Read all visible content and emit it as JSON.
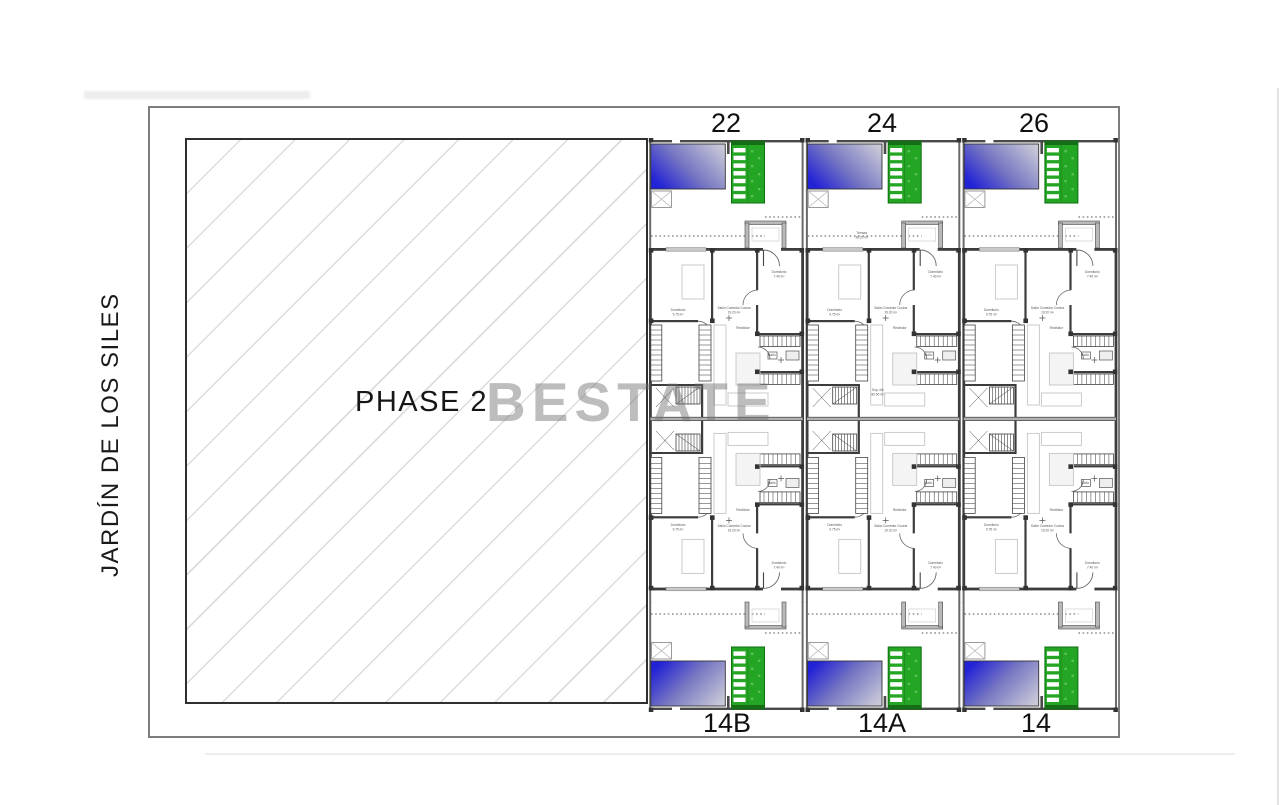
{
  "site_plan": {
    "street_label": "JARDÍN DE LOS SILES",
    "phase_label": "PHASE 2",
    "watermark": "BESTATE",
    "units_top": [
      "22",
      "24",
      "26"
    ],
    "units_bottom": [
      "14B",
      "14A",
      "14"
    ],
    "rooms": {
      "terrace": "Terraza",
      "terrace_sup": "38.20 m²",
      "util": "Sup. útil",
      "util_sup": "89.50 m²",
      "bedroom": "Dormitorio",
      "bedroom_sup": "9.75 m²",
      "bedroom2": "Dormitorio",
      "bedroom2_sup": "7.40 m²",
      "bath": "Baño",
      "living": "Salón Comedor Cocina",
      "living_sup": "19.20 m²",
      "hall": "Recibidor"
    },
    "colors": {
      "pool_blue": "#2222d6",
      "pool_fade": "#c8c8d8",
      "deck_green": "#24a524",
      "wall": "#3d3d3d",
      "hatch_line": "#dcdcdc",
      "watermark_gray": "#6f6f6f"
    }
  }
}
